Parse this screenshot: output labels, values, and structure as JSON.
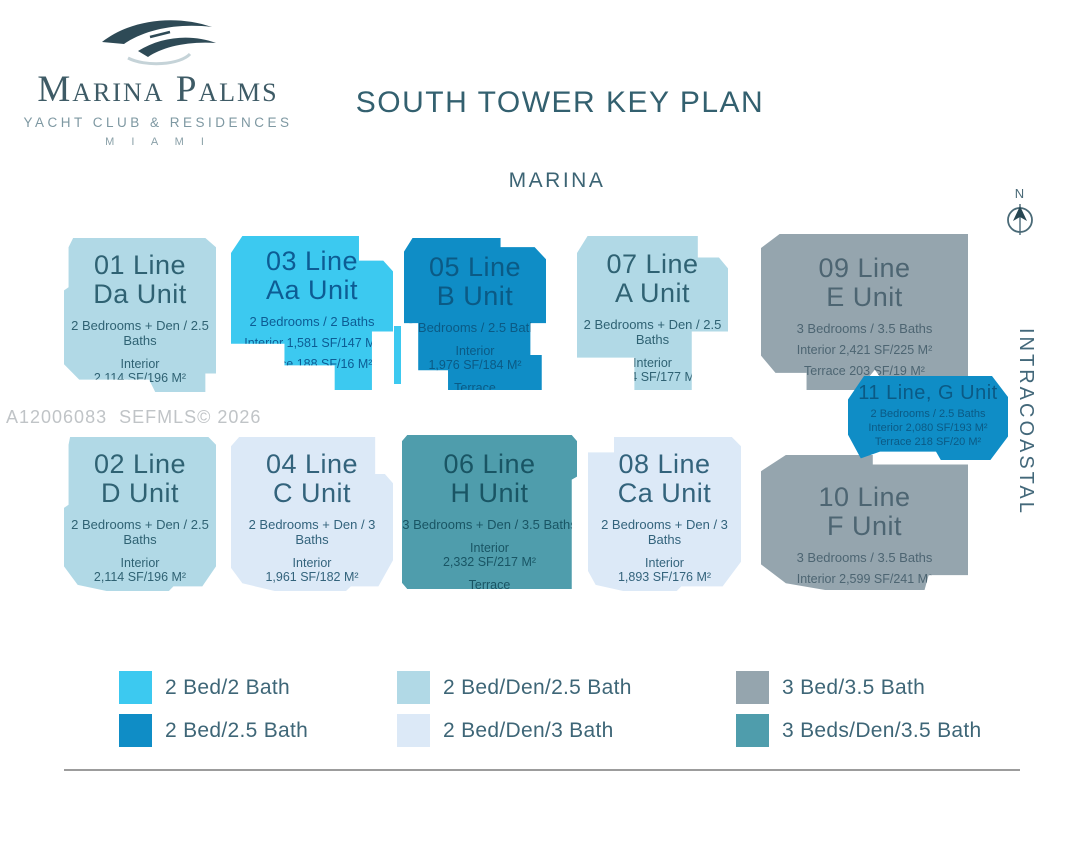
{
  "logo": {
    "name": "Marina Palms",
    "tagline": "YACHT CLUB & RESIDENCES",
    "city": "M I A M I"
  },
  "header": {
    "title": "SOUTH TOWER KEY PLAN"
  },
  "labels": {
    "marina": "MARINA",
    "intracoastal": "INTRACOASTAL",
    "north": "N",
    "watermark": "A12006083  SEFMLS© 2026"
  },
  "units": [
    {
      "id": "01",
      "line": "01 Line",
      "unit": "Da Unit",
      "bedrooms": "2 Bedrooms + Den / 2.5 Baths",
      "d1": "Interior",
      "d2": "2,114 SF/196 M²",
      "d3": "Terrace",
      "d4": "241 SF/22 M²"
    },
    {
      "id": "03",
      "line": "03 Line",
      "unit": "Aa Unit",
      "bedrooms": "2 Bedrooms / 2 Baths",
      "d1": "Interior 1,581 SF/147 M²",
      "d2": "Terrace 188 SF/16 M²"
    },
    {
      "id": "05",
      "line": "05 Line",
      "unit": "B Unit",
      "bedrooms": "2 Bedrooms / 2.5 Baths",
      "d1": "Interior",
      "d2": "1,976 SF/184 M²",
      "d3": "Terrace",
      "d4": "197 SF/18 M²"
    },
    {
      "id": "07",
      "line": "07 Line",
      "unit": "A Unit",
      "bedrooms": "2 Bedrooms + Den / 2.5 Baths",
      "d1": "Interior",
      "d2": "1,904 SF/177 M²",
      "d3": "Terrace",
      "d4": "169 SF/16 M²"
    },
    {
      "id": "09",
      "line": "09 Line",
      "unit": "E Unit",
      "bedrooms": "3 Bedrooms / 3.5 Baths",
      "d1": "Interior 2,421 SF/225 M²",
      "d2": "Terrace 203 SF/19 M²"
    },
    {
      "id": "11",
      "line": "11 Line, G Unit",
      "unit": "",
      "bedrooms": "2 Bedrooms / 2.5 Baths",
      "d1": "Interior 2,080 SF/193 M²",
      "d2": "Terrace 218 SF/20 M²"
    },
    {
      "id": "02",
      "line": "02 Line",
      "unit": "D Unit",
      "bedrooms": "2 Bedrooms + Den / 2.5 Baths",
      "d1": "Interior",
      "d2": "2,114 SF/196 M²",
      "d3": "Terrace",
      "d4": "241 SF/22 M²"
    },
    {
      "id": "04",
      "line": "04 Line",
      "unit": "C Unit",
      "bedrooms": "2 Bedrooms + Den / 3 Baths",
      "d1": "Interior",
      "d2": "1,961 SF/182 M²",
      "d3": "Terrace",
      "d4": "210 SF/20 M²"
    },
    {
      "id": "06",
      "line": "06 Line",
      "unit": "H Unit",
      "bedrooms": "3 Bedrooms + Den / 3.5 Baths",
      "d1": "Interior",
      "d2": "2,332 SF/217 M²",
      "d3": "Terrace",
      "d4": "190 SF/18 M²"
    },
    {
      "id": "08",
      "line": "08 Line",
      "unit": "Ca Unit",
      "bedrooms": "2 Bedrooms + Den / 3 Baths",
      "d1": "Interior",
      "d2": "1,893 SF/176 M²",
      "d3": "Terrace",
      "d4": "214 SF/20 M²"
    },
    {
      "id": "10",
      "line": "10 Line",
      "unit": "F Unit",
      "bedrooms": "3 Bedrooms / 3.5 Baths",
      "d1": "Interior 2,599 SF/241 M²",
      "d2": "Terrace 203 SF/19 M²"
    }
  ],
  "legend": {
    "items": [
      {
        "label": "2 Bed/2 Bath",
        "color": "#3cc9f0"
      },
      {
        "label": "2 Bed/Den/2.5 Bath",
        "color": "#b1d9e6"
      },
      {
        "label": "3 Bed/3.5 Bath",
        "color": "#95a5ae"
      },
      {
        "label": "2 Bed/2.5 Bath",
        "color": "#0f8dc6"
      },
      {
        "label": "2 Bed/Den/3 Bath",
        "color": "#dce9f7"
      },
      {
        "label": "3 Beds/Den/3.5 Bath",
        "color": "#4f9dac"
      }
    ]
  }
}
